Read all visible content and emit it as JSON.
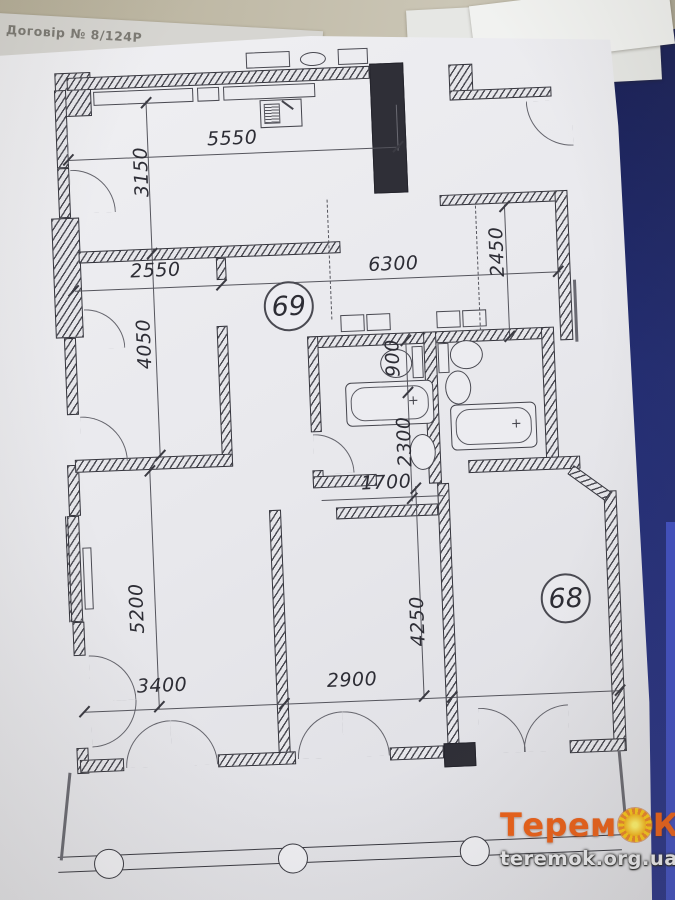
{
  "photo": {
    "underlying_note": "Договір № 8/124Р"
  },
  "plan": {
    "unit_circles": {
      "unit69": "69",
      "unit68": "68"
    },
    "dims": {
      "d5550": "5550",
      "d3150": "3150",
      "d2550": "2550",
      "d6300": "6300",
      "d2450": "2450",
      "d4050": "4050",
      "d900": "900",
      "d2300": "2300",
      "d1700": "1700",
      "d5200": "5200",
      "d4250": "4250",
      "d3400": "3400",
      "d2900": "2900"
    }
  },
  "watermark": {
    "brand_prefix": "Терем",
    "brand_suffix": "К",
    "url": "teremok.org.ua",
    "brand_color": "#e8601a",
    "sun_color": "#f6c51a",
    "url_color": "#e9e9ec"
  },
  "colors": {
    "paper": "#e9e9ed",
    "desk": "#b6af99",
    "folder_blue": "#232d72",
    "ink": "#34343c"
  }
}
